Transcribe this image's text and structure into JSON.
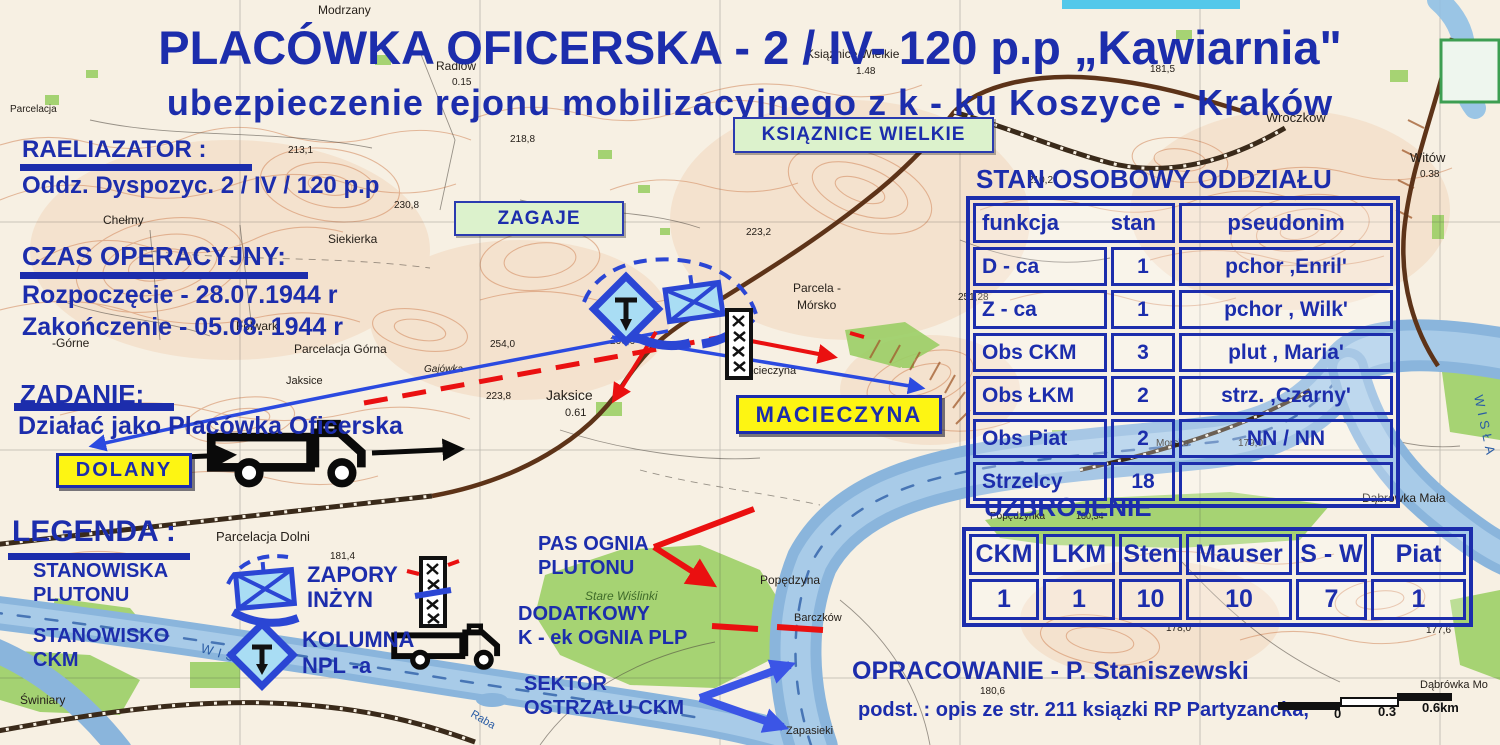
{
  "colors": {
    "overlay_blue": "#1c2dac",
    "red": "#ea1010",
    "arrow_blue": "#2b4ae0",
    "symbol_blue": "#2b46d4",
    "yellow_label_bg": "#fdf513",
    "green_label_bg": "#dcf2cc"
  },
  "header": {
    "title": "PLACÓWKA OFICERSKA - 2 / IV- 120 p.p „Kawiarnia\"",
    "subtitle": "ubezpieczenie rejonu mobilizacyjnego z k - ku Koszyce - Kraków"
  },
  "info": {
    "realizator_heading": "RAELIAZATOR :",
    "realizator_value": "Oddz. Dyspozyc. 2 / IV / 120 p.p",
    "time_heading": "CZAS OPERACYJNY:",
    "time_start": "Rozpoczęcie - 28.07.1944  r",
    "time_end": "Zakończenie - 05.08. 1944 r",
    "task_heading": "ZADANIE:",
    "task_value": "Działać jako Placówka Oficerska"
  },
  "legend": {
    "heading": "LEGENDA :",
    "entries": [
      {
        "icon": "platoon-positions",
        "lines": [
          "STANOWISKA",
          "PLUTONU"
        ]
      },
      {
        "icon": "ckm-position",
        "lines": [
          "STANOWISKO",
          "CKM"
        ]
      },
      {
        "icon": "engineer-obstacles",
        "lines": [
          "ZAPORY",
          "INŻYN"
        ]
      },
      {
        "icon": "npl-column",
        "lines": [
          "KOLUMNA",
          "NPL -a"
        ]
      }
    ]
  },
  "place_labels": {
    "dolany": "DOLANY",
    "macieczyna": "MACIECZYNA",
    "ksiaznice_wielkie": "KSIĄZNICE  WIELKIE",
    "zagaje": "ZAGAJE"
  },
  "fire_labels": {
    "pas": [
      "PAS OGNIA",
      "PLUTONU"
    ],
    "dodatkowy": [
      "DODATKOWY",
      "K - ek OGNIA PLP"
    ],
    "sektor": [
      "SEKTOR",
      "OSTRZAŁU CKM"
    ]
  },
  "personnel_table": {
    "title": "STAN OSOBOWY ODDZIAŁU",
    "headers": [
      "funkcja",
      "stan",
      "pseudonim"
    ],
    "rows": [
      [
        "D - ca",
        "1",
        "pchor ,Enril'"
      ],
      [
        "Z - ca",
        "1",
        "pchor , Wilk'"
      ],
      [
        "Obs CKM",
        "3",
        "plut , Maria'"
      ],
      [
        "Obs ŁKM",
        "2",
        "strz. ,Czarny'"
      ],
      [
        "Obs Piat",
        "2",
        "NN / NN"
      ],
      [
        "Strzelcy",
        "18",
        ""
      ]
    ]
  },
  "armament_table": {
    "title": "UZBROJENIE",
    "headers": [
      "CKM",
      "LKM",
      "Sten",
      "Mauser",
      "S - W",
      "Piat"
    ],
    "values": [
      "1",
      "1",
      "10",
      "10",
      "7",
      "1"
    ]
  },
  "credits": {
    "author_line": "OPRACOWANIE - P. Staniszewski",
    "source_line": "podst. : opis ze str. 211 ksiązki RP Partyzancka,"
  },
  "scale_bar": {
    "labels": [
      "0",
      "0.3",
      "0.6km"
    ]
  },
  "map_labels": [
    {
      "t": "Modrzany",
      "x": 318,
      "y": 14,
      "s": 12
    },
    {
      "t": "Radlów",
      "x": 436,
      "y": 70,
      "s": 12
    },
    {
      "t": "0.15",
      "x": 452,
      "y": 85,
      "s": 10
    },
    {
      "t": "Ksiąznice Wielkie",
      "x": 806,
      "y": 58,
      "s": 12
    },
    {
      "t": "1.48",
      "x": 856,
      "y": 74,
      "s": 10
    },
    {
      "t": "Wroczków",
      "x": 1266,
      "y": 122,
      "s": 13
    },
    {
      "t": "181,5",
      "x": 1150,
      "y": 72,
      "s": 10
    },
    {
      "t": "Witów",
      "x": 1410,
      "y": 162,
      "s": 13
    },
    {
      "t": "0.38",
      "x": 1420,
      "y": 177,
      "s": 10
    },
    {
      "t": "Parcelacja",
      "x": 10,
      "y": 112,
      "s": 10
    },
    {
      "t": "213,1",
      "x": 288,
      "y": 153,
      "s": 10
    },
    {
      "t": "218,8",
      "x": 510,
      "y": 142,
      "s": 10
    },
    {
      "t": "230,8",
      "x": 394,
      "y": 208,
      "s": 10
    },
    {
      "t": "210,2",
      "x": 1028,
      "y": 183,
      "s": 10
    },
    {
      "t": "Chełmy",
      "x": 103,
      "y": 224,
      "s": 12
    },
    {
      "t": "Siekierka",
      "x": 328,
      "y": 243,
      "s": 12
    },
    {
      "t": "223,2",
      "x": 746,
      "y": 235,
      "s": 10
    },
    {
      "t": "-Górne",
      "x": 52,
      "y": 347,
      "s": 12
    },
    {
      "t": "Folwark",
      "x": 236,
      "y": 330,
      "s": 12
    },
    {
      "t": "Parcelacja Górna",
      "x": 294,
      "y": 353,
      "s": 12
    },
    {
      "t": "Jaksice",
      "x": 286,
      "y": 384,
      "s": 11
    },
    {
      "t": "Gajówka",
      "x": 424,
      "y": 372,
      "s": 10,
      "i": 1
    },
    {
      "t": "254,0",
      "x": 490,
      "y": 347,
      "s": 10
    },
    {
      "t": "266,6",
      "x": 610,
      "y": 344,
      "s": 10
    },
    {
      "t": "223,8",
      "x": 486,
      "y": 399,
      "s": 10
    },
    {
      "t": "Parcela -",
      "x": 793,
      "y": 292,
      "s": 12
    },
    {
      "t": "Mórsko",
      "x": 797,
      "y": 309,
      "s": 12
    },
    {
      "t": "251,28",
      "x": 958,
      "y": 300,
      "s": 10
    },
    {
      "t": "Macieczyna",
      "x": 738,
      "y": 374,
      "s": 11
    },
    {
      "t": "Jaksice",
      "x": 546,
      "y": 400,
      "s": 14
    },
    {
      "t": "0.61",
      "x": 565,
      "y": 416,
      "s": 11
    },
    {
      "t": "Parcelacja Dolni",
      "x": 216,
      "y": 541,
      "s": 13
    },
    {
      "t": "181,4",
      "x": 330,
      "y": 559,
      "s": 10
    },
    {
      "t": "Stare Wiślinki",
      "x": 585,
      "y": 600,
      "s": 12,
      "i": 1,
      "c": "#3f6b2a"
    },
    {
      "t": "Popędzyna",
      "x": 760,
      "y": 584,
      "s": 12
    },
    {
      "t": "Barczków",
      "x": 794,
      "y": 621,
      "s": 11
    },
    {
      "t": "Morsko",
      "x": 1156,
      "y": 446,
      "s": 10
    },
    {
      "t": "179,0",
      "x": 1238,
      "y": 446,
      "s": 10
    },
    {
      "t": "178,0",
      "x": 1166,
      "y": 631,
      "s": 10
    },
    {
      "t": "Dąbrówka Mała",
      "x": 1362,
      "y": 502,
      "s": 12
    },
    {
      "t": "Dąbrówka Mo",
      "x": 1420,
      "y": 688,
      "s": 11
    },
    {
      "t": "177,6",
      "x": 1426,
      "y": 633,
      "s": 10
    },
    {
      "t": "Świniary",
      "x": 20,
      "y": 704,
      "s": 12
    },
    {
      "t": "Zapasieki",
      "x": 786,
      "y": 734,
      "s": 11
    },
    {
      "t": "Popędzynka",
      "x": 990,
      "y": 519,
      "s": 10
    },
    {
      "t": "180,34",
      "x": 1076,
      "y": 519,
      "s": 9
    },
    {
      "t": "180,6",
      "x": 980,
      "y": 694,
      "s": 10
    },
    {
      "t": "WISŁA",
      "x": 200,
      "y": 652,
      "s": 13,
      "c": "#2a5ca5",
      "r": 16,
      "sp": 5
    },
    {
      "t": "WISŁA",
      "x": 1474,
      "y": 396,
      "s": 13,
      "c": "#2a5ca5",
      "r": 78,
      "sp": 5
    },
    {
      "t": "Raba",
      "x": 470,
      "y": 716,
      "s": 11,
      "c": "#2a5ca5",
      "r": 30
    }
  ]
}
